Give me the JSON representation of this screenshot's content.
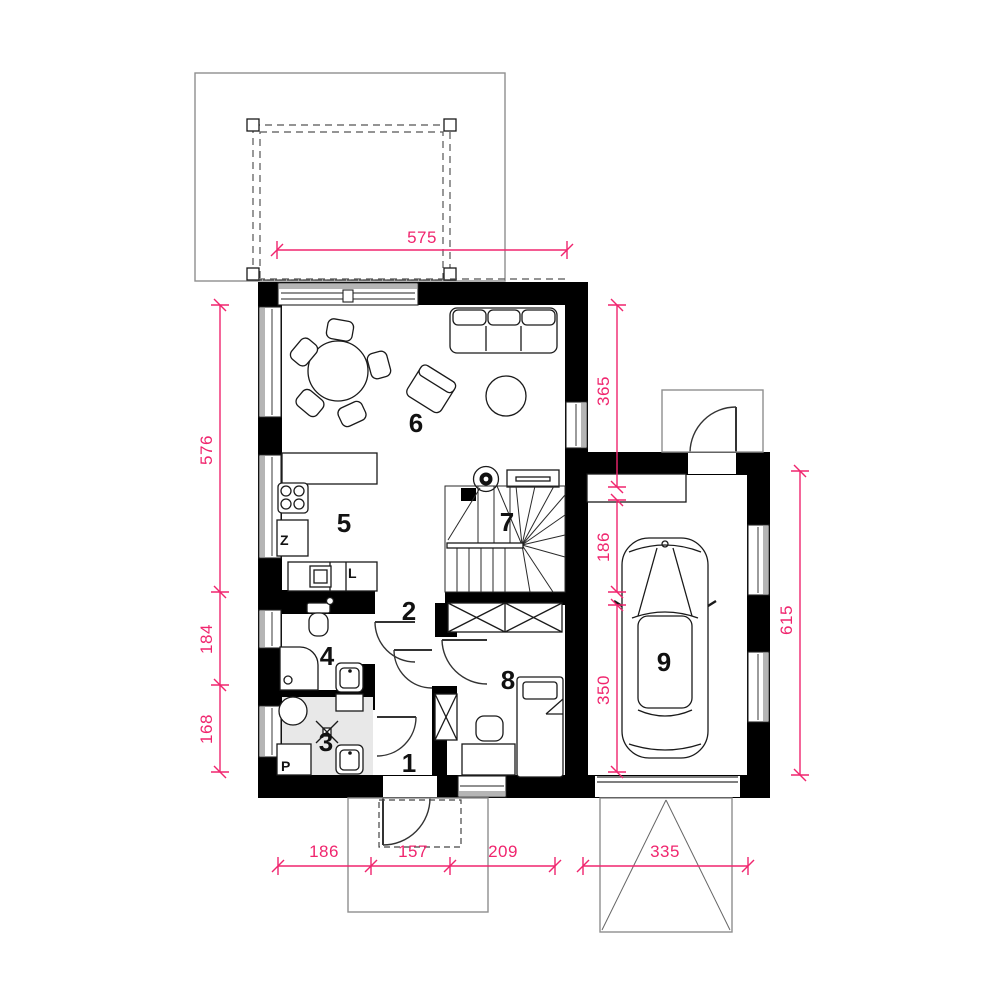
{
  "page": {
    "background": "#ffffff"
  },
  "plan": {
    "rooms": [
      {
        "number": "1"
      },
      {
        "number": "2"
      },
      {
        "number": "3"
      },
      {
        "number": "4"
      },
      {
        "number": "5"
      },
      {
        "number": "6"
      },
      {
        "number": "7"
      },
      {
        "number": "8"
      },
      {
        "number": "9"
      }
    ],
    "appliance_labels": {
      "freezer": "Z",
      "fridge": "L",
      "washer": "P"
    },
    "dimensions": {
      "terrace_width": "575",
      "left": [
        "576",
        "184",
        "168"
      ],
      "right": [
        "365",
        "186",
        "350"
      ],
      "right_total": "615",
      "bottom": [
        "186",
        "157",
        "209",
        "335"
      ]
    },
    "colors": {
      "dimension": "#f0256e",
      "wall": "#000000",
      "bath_floor": "#e8e8e8",
      "terrace_outline": "#a9a9a9"
    }
  }
}
